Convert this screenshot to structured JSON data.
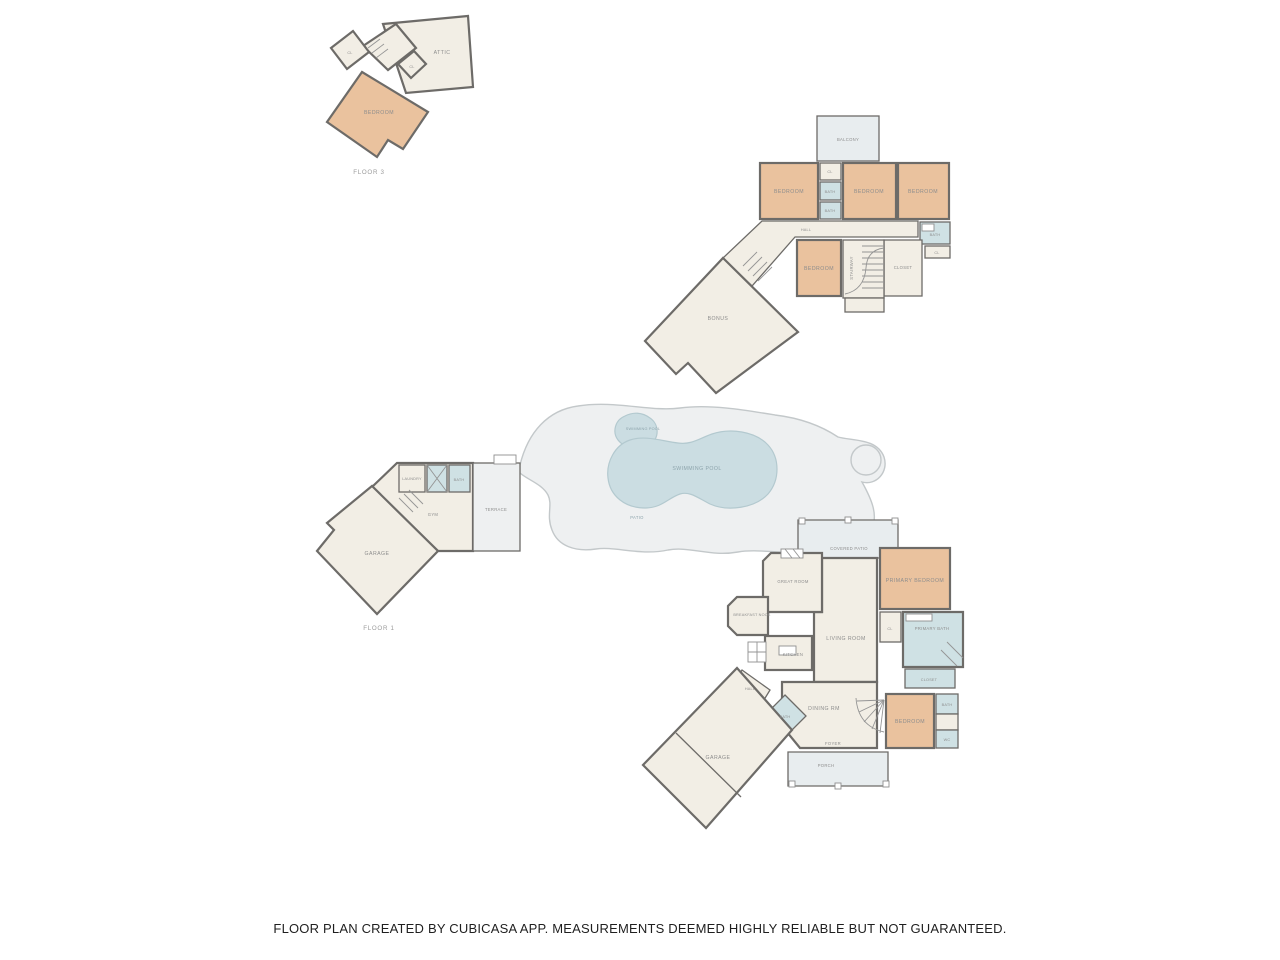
{
  "colors": {
    "wall": "#6d6b68",
    "floor": "#f2eee5",
    "bedroom": "#eac29e",
    "bath": "#cfe1e4",
    "patio": "#e8edef",
    "deck": "#eef0f1",
    "water": "#cbdde2",
    "label": "#8d8d8d"
  },
  "footer": {
    "disclaimer": "FLOOR PLAN CREATED BY CUBICASA APP. MEASUREMENTS DEEMED HIGHLY RELIABLE BUT NOT GUARANTEED."
  },
  "floor3": {
    "label": "FLOOR 3",
    "rooms": {
      "attic": "ATTIC",
      "bedroom": "BEDROOM",
      "closet_a": "CL",
      "closet_b": "CL"
    }
  },
  "floor2": {
    "rooms": {
      "balcony": "BALCONY",
      "bedroom_left": "BEDROOM",
      "bedroom_middle": "BEDROOM",
      "bedroom_right": "BEDROOM",
      "closet_top": "CL",
      "bath_upper": "BATH",
      "bath_lower": "BATH",
      "hall": "HALL",
      "bath_right": "BATH",
      "closet_small": "CL",
      "closet": "CLOSET",
      "bedroom_center": "BEDROOM",
      "stairway": "STAIRWAY",
      "bonus": "BONUS"
    }
  },
  "floor1": {
    "label": "FLOOR 1",
    "rooms": {
      "garage_west": "GARAGE",
      "laundry": "LAUNDRY",
      "bath_pool": "BATH",
      "gym": "GYM",
      "terrace": "TERRACE",
      "patio": "PATIO",
      "spa": "SWIMMING POOL",
      "pool": "SWIMMING POOL",
      "covered_patio": "COVERED PATIO",
      "great_room": "GREAT ROOM",
      "breakfast_nook": "BREAKFAST NOOK",
      "kitchen": "KITCHEN",
      "living_room": "LIVING ROOM",
      "primary_bedroom": "PRIMARY BEDROOM",
      "primary_bath": "PRIMARY BATH",
      "closet_cl": "CL",
      "closet": "CLOSET",
      "bedroom": "BEDROOM",
      "bath_guest": "BATH",
      "wc": "WC",
      "dining": "DINING RM",
      "foyer": "FOYER",
      "hall": "HALL",
      "bath_hall": "BATH",
      "porch": "PORCH",
      "garage_east": "GARAGE"
    }
  }
}
